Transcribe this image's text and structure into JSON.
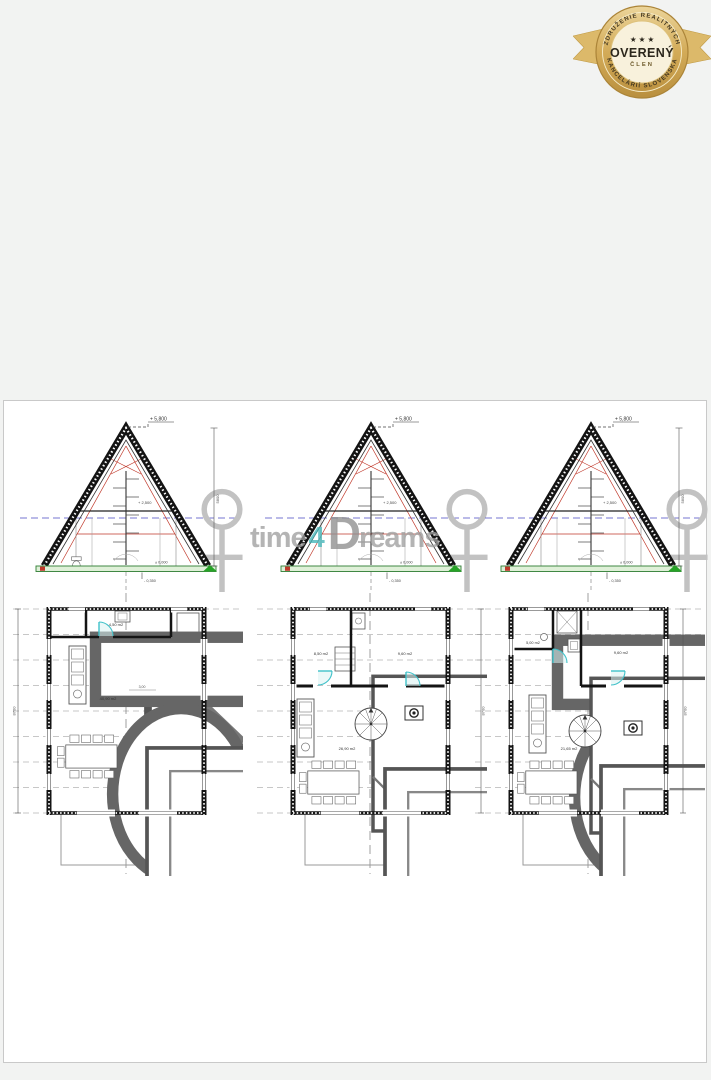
{
  "badge": {
    "arc_top": "ZDRUŽENIE REALITNÝCH",
    "arc_bottom": "KANCELÁRIÍ SLOVENSKA",
    "stars": "★ ★ ★",
    "title": "OVERENÝ",
    "subtitle": "ČLEN"
  },
  "watermark": {
    "word1": "time",
    "word2": "4",
    "word3": "D",
    "word4": "reams"
  },
  "colors": {
    "background": "#f2f3f2",
    "sheet": "#ffffff",
    "wall_line": "#141414",
    "red_line": "#c0392b",
    "green_base": "#2e7d32",
    "blue_dashed": "#7676d2",
    "teal_door": "#3fc1c9",
    "badge_gold": "#c9a24d",
    "watermark_gray": "#9f9f9f",
    "watermark_teal": "#46b6b9"
  },
  "sections": [
    {
      "top_level": "+ 5,800",
      "mid_level": "+ 2,500",
      "floor_level": "± 0,000",
      "base_level": "- 0,350",
      "height_dim": "5800"
    },
    {
      "top_level": "+ 5,800",
      "mid_level": "+ 2,500",
      "floor_level": "± 0,000",
      "base_level": "- 0,350",
      "height_dim": "5800"
    },
    {
      "top_level": "+ 5,800",
      "mid_level": "+ 2,500",
      "floor_level": "± 0,000",
      "base_level": "- 0,350",
      "height_dim": "5800"
    }
  ],
  "plans": [
    {
      "area_small": "4,50 m2",
      "area_main": "40,90 m2",
      "inner_dim": "3,00",
      "side_dim": "8700"
    },
    {
      "area_left": "8,50 m2",
      "area_right": "9,60 m2",
      "area_main": "26,90 m2",
      "side_dim": "8700"
    },
    {
      "area_small": "5,00 m2",
      "area_right": "9,60 m2",
      "area_main": "21,65 m2",
      "side_dim": "8700"
    }
  ]
}
